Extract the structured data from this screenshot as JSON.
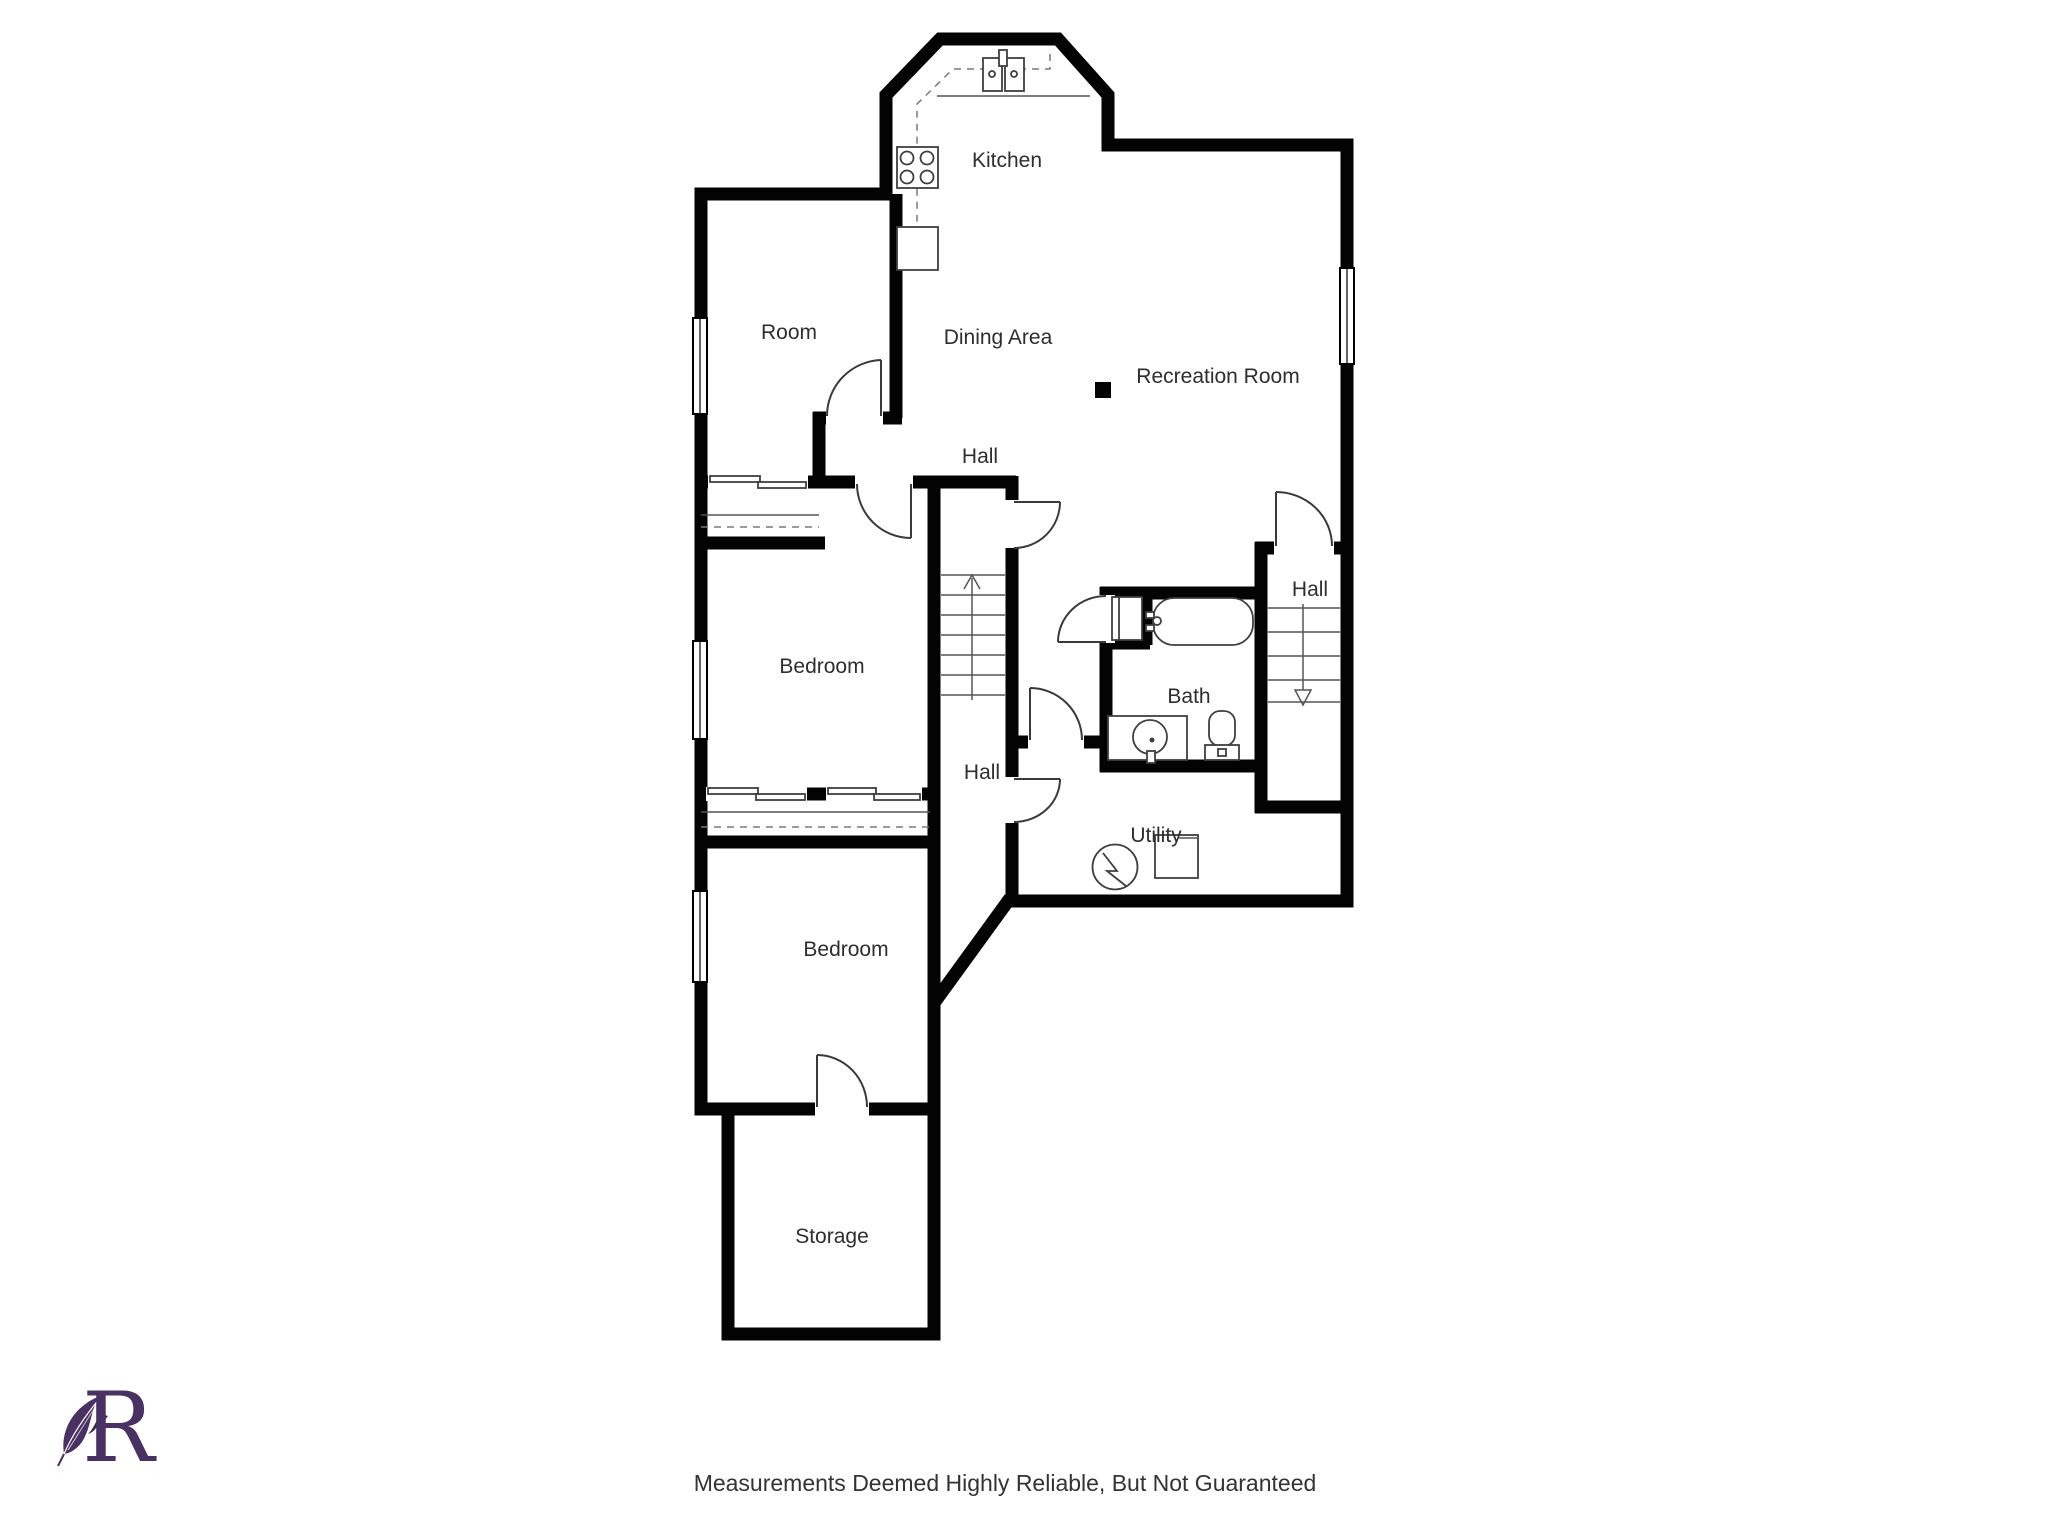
{
  "page": {
    "background": "#ffffff"
  },
  "floorplan": {
    "wall_color": "#030303",
    "label_color": "#2e2e2e",
    "rooms": {
      "kitchen": "Kitchen",
      "dining": "Dining Area",
      "recreation": "Recreation Room",
      "hall_upper": "Hall",
      "room": "Room",
      "bedroom_middle": "Bedroom",
      "hall_right": "Hall",
      "bath": "Bath",
      "hall_center": "Hall",
      "utility": "Utility",
      "bedroom_lower": "Bedroom",
      "storage": "Storage"
    },
    "fixtures": {
      "kitchen": [
        "stove",
        "double-sink",
        "counter",
        "cabinet"
      ],
      "bath": [
        "bathtub",
        "vanity-sink",
        "toilet",
        "shower-cabinet"
      ],
      "utility": [
        "water-heater",
        "furnace"
      ],
      "stairs": [
        "stairs-up",
        "stairs-down"
      ]
    }
  },
  "logo": {
    "letter": "R",
    "color": "#4a3163"
  },
  "footer": {
    "disclaimer": "Measurements Deemed Highly Reliable, But Not Guaranteed"
  }
}
